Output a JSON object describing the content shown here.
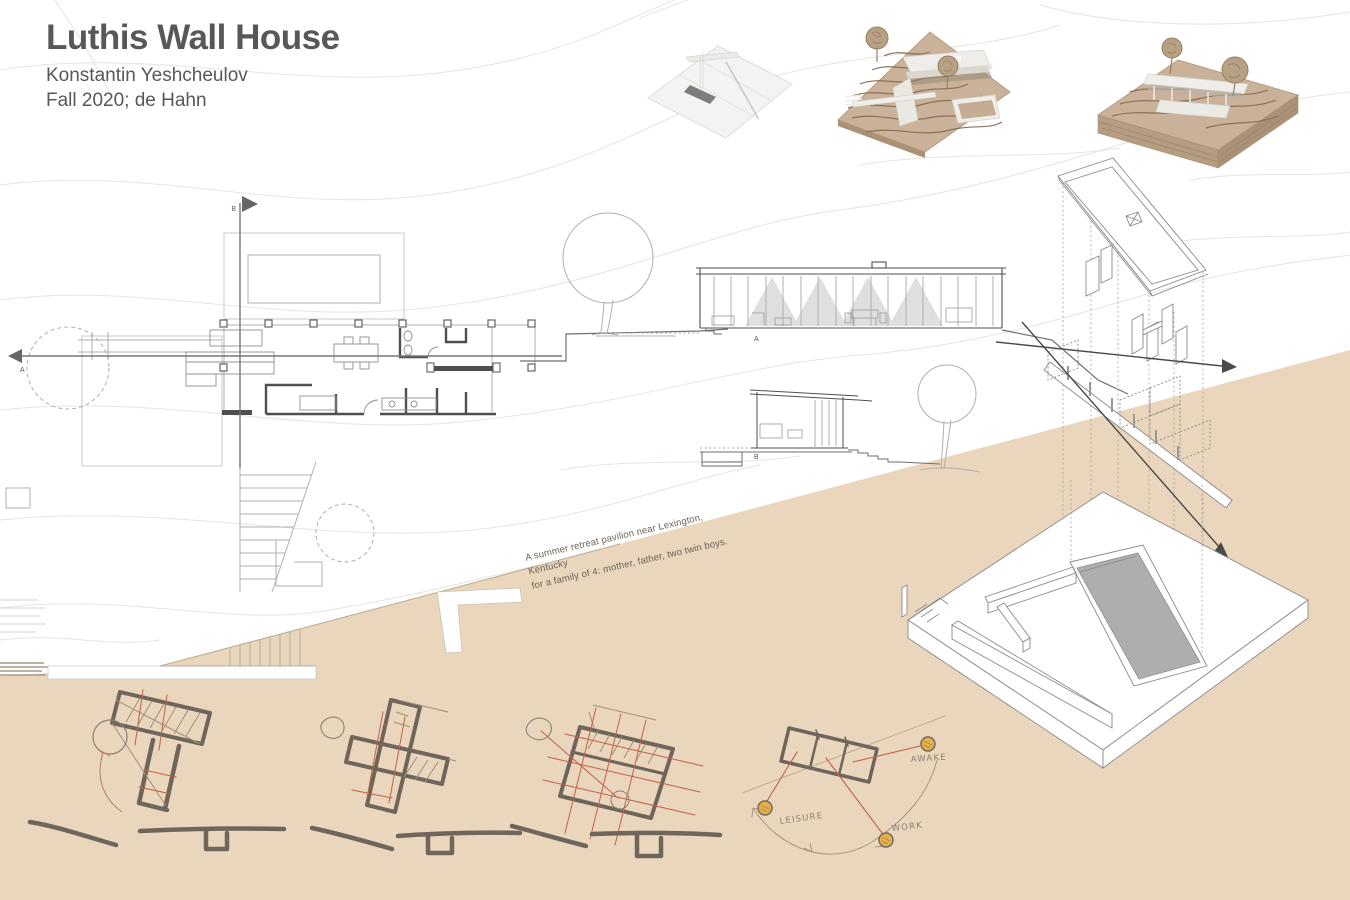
{
  "board": {
    "title": "Luthis Wall House",
    "author": "Konstantin Yeshcheulov",
    "term": "Fall 2020; de Hahn"
  },
  "annotation": {
    "line1": "A summer retreat pavilion near Lexington, Kentucky",
    "line2": "for a family of 4: mother, father, two twin boys."
  },
  "plan_markers": {
    "section_a": "A",
    "section_b": "B"
  },
  "section_labels": {
    "a": "A",
    "b": "B"
  },
  "program_diagram": {
    "leisure": "LEISURE",
    "work": "WORK",
    "awake": "AWAKE"
  },
  "colors": {
    "title_text": "#57585a",
    "hillside": "#e9d6bc",
    "sketch_ink": "#6f655a",
    "accent_red": "#c4604a",
    "node_yellow": "#e2b04c",
    "drawing_line": "#8a8a8a",
    "contour": "#e7e4de",
    "cardboard": "#c9b299",
    "recessed_gray": "#aeaeae",
    "annotation_text": "#6b6257",
    "handwriting": "#8d8071"
  }
}
